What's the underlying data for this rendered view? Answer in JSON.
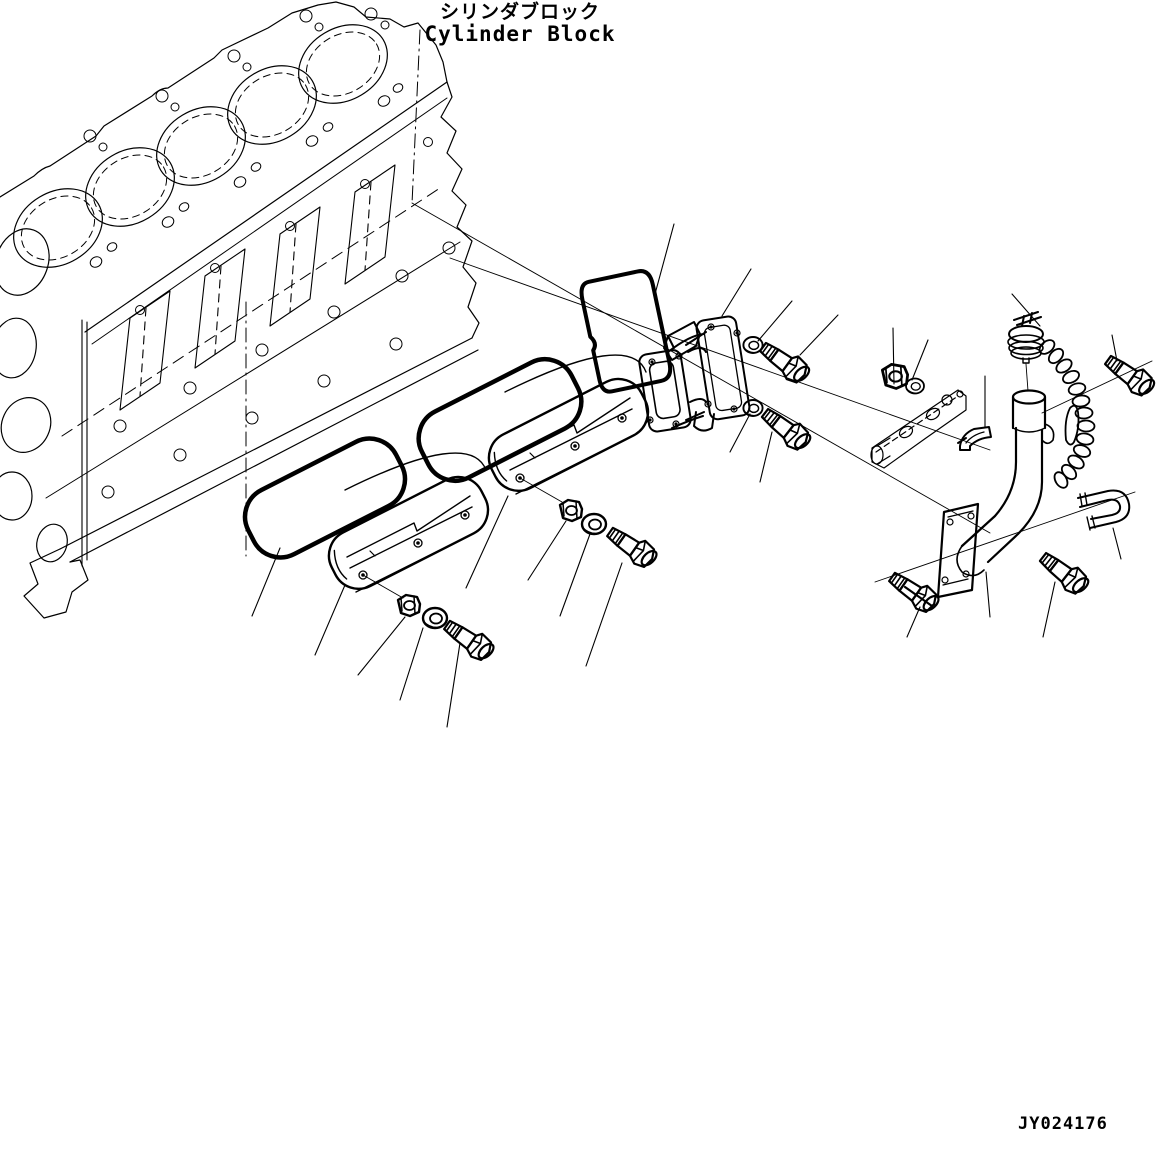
{
  "title": {
    "ja": "シリンダブロック",
    "en": "Cylinder Block"
  },
  "drawing_number": "JY024176",
  "colors": {
    "line": "#000000",
    "background": "#ffffff"
  },
  "diagram": {
    "type": "exploded-parts-drawing",
    "parts": [
      "cylinder-block",
      "cover-gasket-lower",
      "cover-gasket-upper",
      "side-cover-lower",
      "side-cover-upper",
      "housing-gasket",
      "cover-housing",
      "hex-nut-lower",
      "hex-nut-upper",
      "hex-nut-bracket",
      "washer-lower",
      "washer-upper",
      "washer-housing-top",
      "washer-housing-bottom",
      "washer-bracket",
      "bolt-lower-cover",
      "bolt-upper-cover",
      "bolt-housing-top",
      "bolt-housing-bottom",
      "bolt-cap-side",
      "bolt-tube-right",
      "bolt-tube-long",
      "bracket",
      "clamp-seat",
      "u-bolt-clamp",
      "oil-filler-tube",
      "tube-flange",
      "filler-cap",
      "cap-chain"
    ]
  }
}
